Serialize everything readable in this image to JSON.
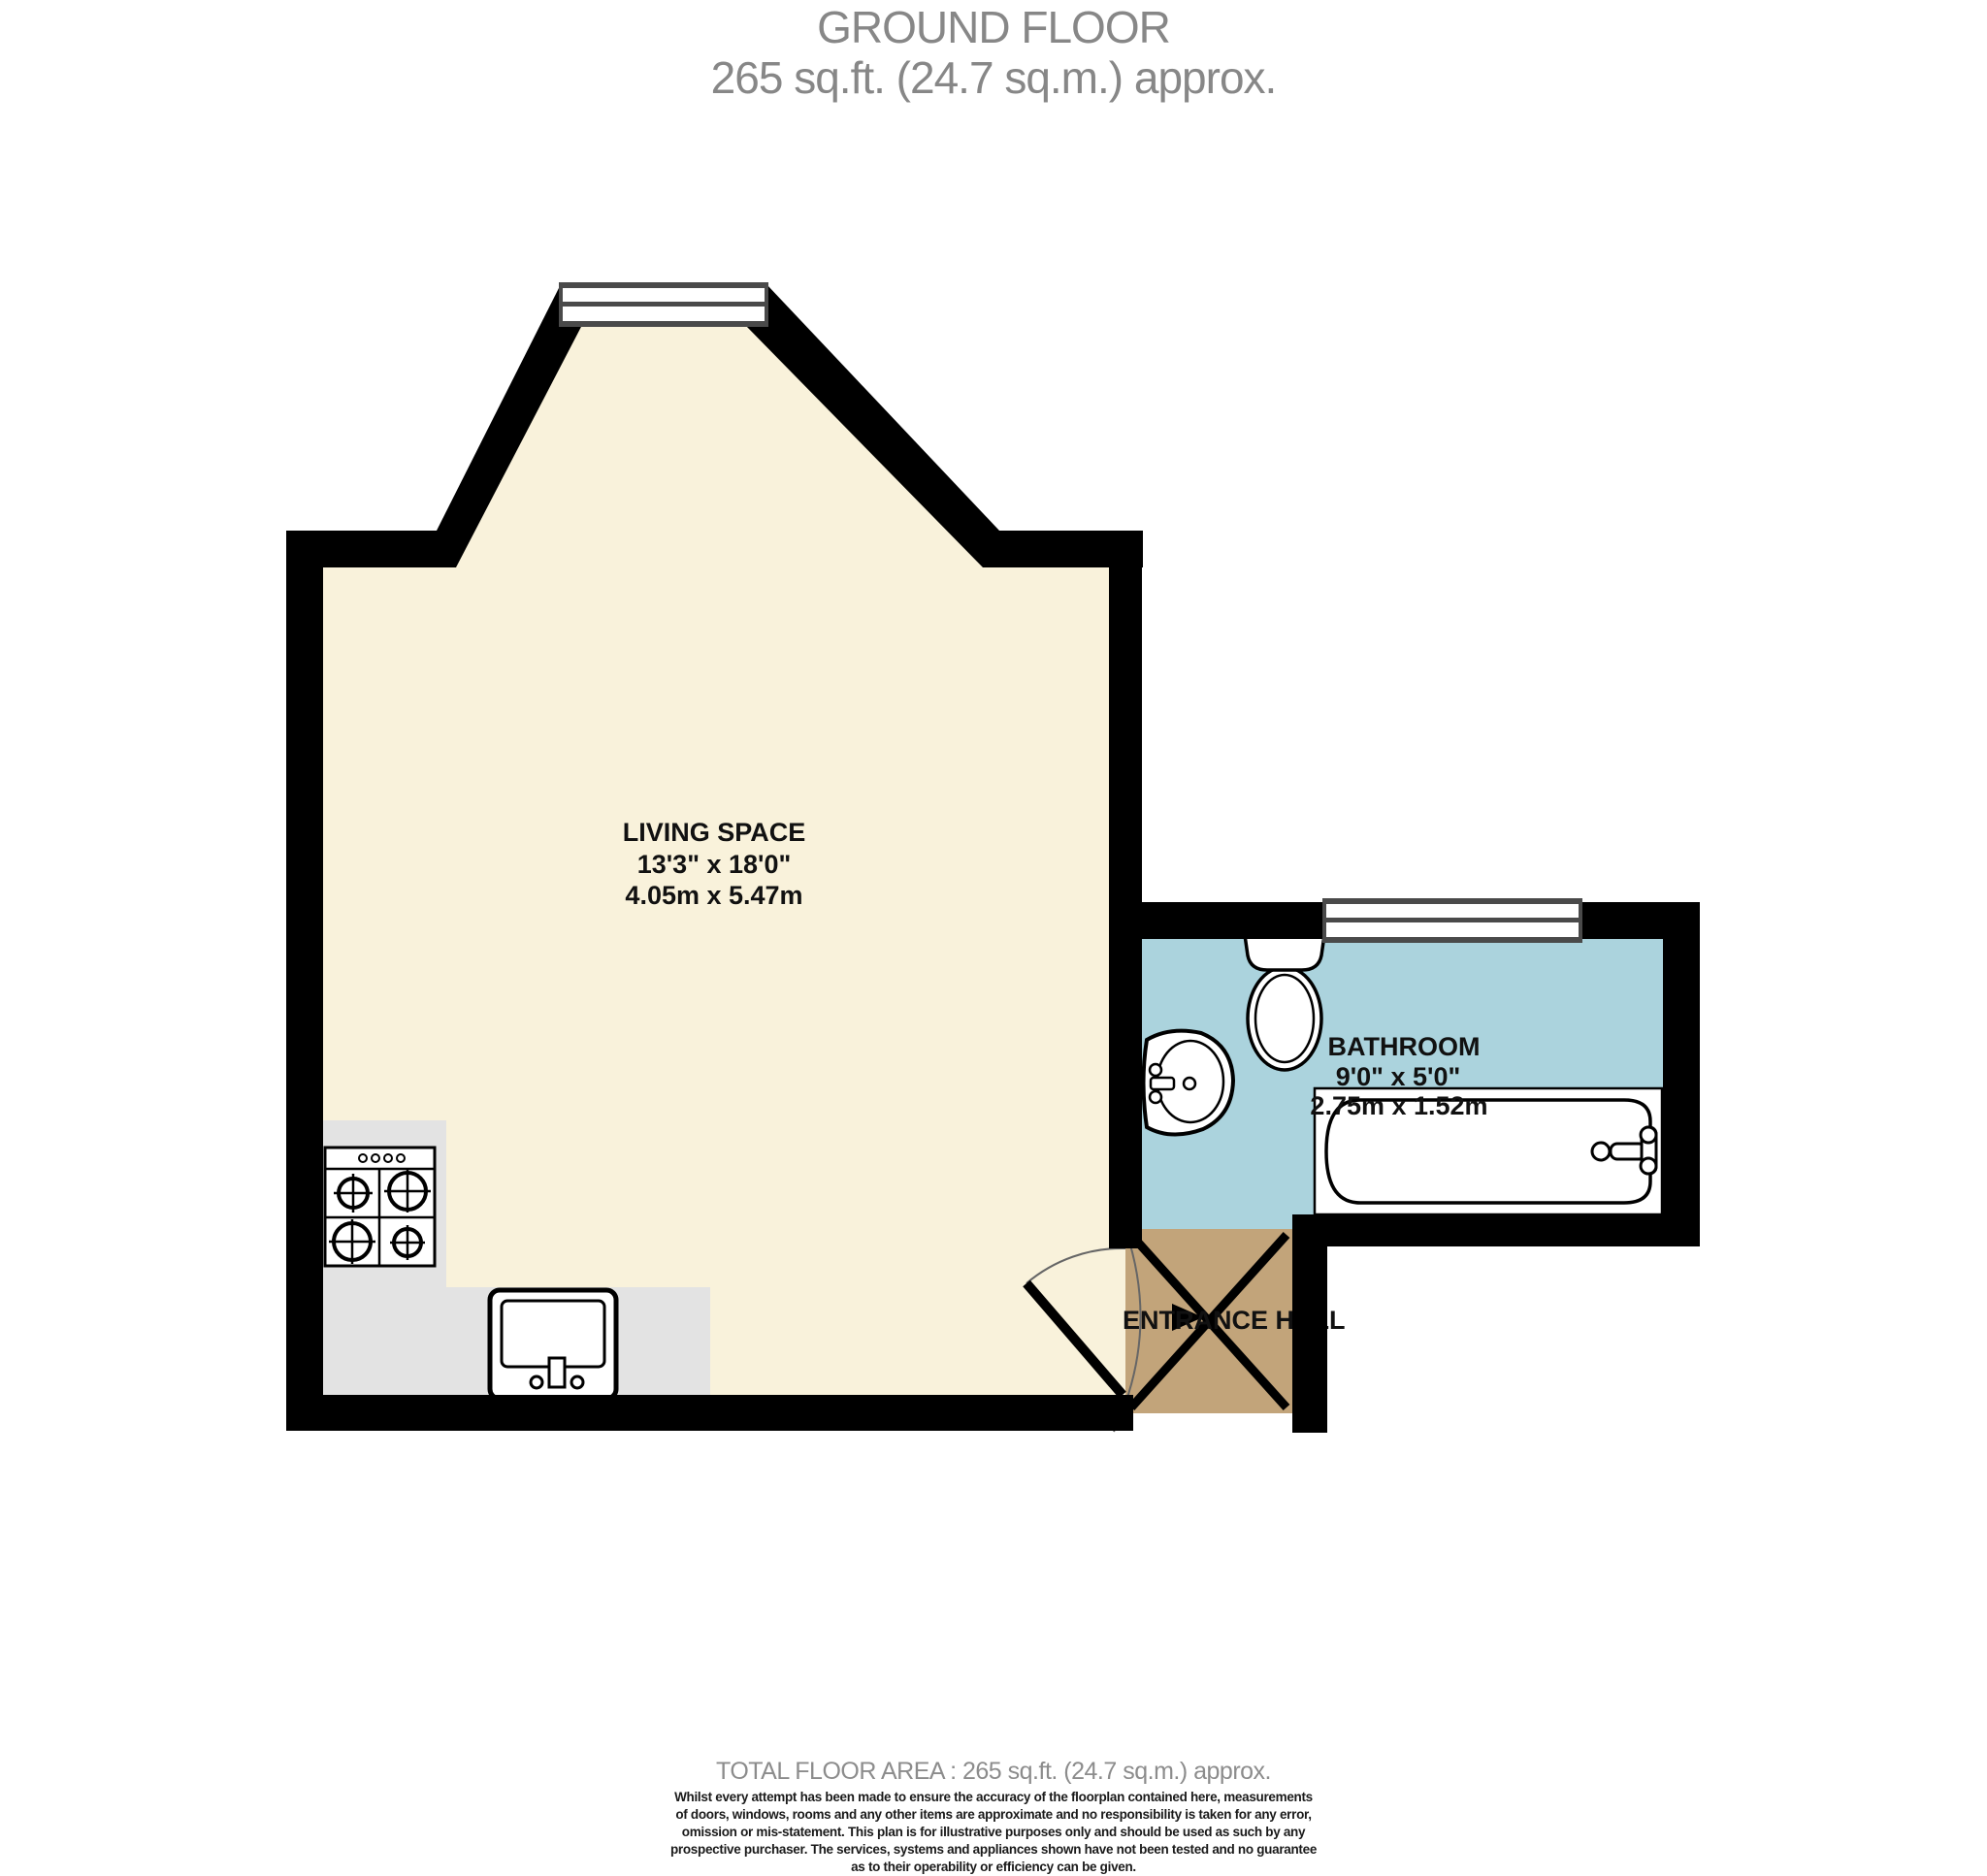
{
  "title": {
    "line1": "GROUND FLOOR",
    "line2": "265 sq.ft. (24.7 sq.m.) approx."
  },
  "rooms": {
    "living": {
      "name": "LIVING SPACE",
      "dim_imperial": "13'3\" x 18'0\"",
      "dim_metric": "4.05m x 5.47m"
    },
    "bathroom": {
      "name": "BATHROOM",
      "dim_imperial": "9'0\" x 5'0\"",
      "dim_metric": "2.75m x 1.52m"
    },
    "entrance": {
      "name": "ENTRANCE HALL"
    }
  },
  "icons": {
    "stove": "stove-icon",
    "kitchen_sink": "kitchen-sink-icon",
    "toilet": "toilet-icon",
    "bathroom_sink": "bathroom-sink-icon",
    "bathtub": "bathtub-icon",
    "entrance_door": "door-x-icon",
    "windows": "window-icon"
  },
  "colors": {
    "floor_living": "#F9F2DB",
    "floor_bathroom": "#ABD3DD",
    "floor_entrance": "#C2A47A",
    "counter": "#E3E3E3",
    "wall": "#000000",
    "window_frame": "#4A4A4A",
    "fixture_fill": "#FFFFFF"
  },
  "footer": {
    "total": "TOTAL FLOOR AREA : 265 sq.ft. (24.7 sq.m.) approx.",
    "disclaimer_lines": [
      "Whilst every attempt has been made to ensure the accuracy of the floorplan contained here, measurements",
      "of doors, windows, rooms and any other items are approximate and no responsibility is taken for any error,",
      "omission or mis-statement. This plan is for illustrative purposes only and should be used as such by any",
      "prospective purchaser. The services, systems and appliances shown have not been tested and no guarantee",
      "as to their operability or efficiency can be given."
    ],
    "credit": "Made with Metropix ©2021"
  }
}
